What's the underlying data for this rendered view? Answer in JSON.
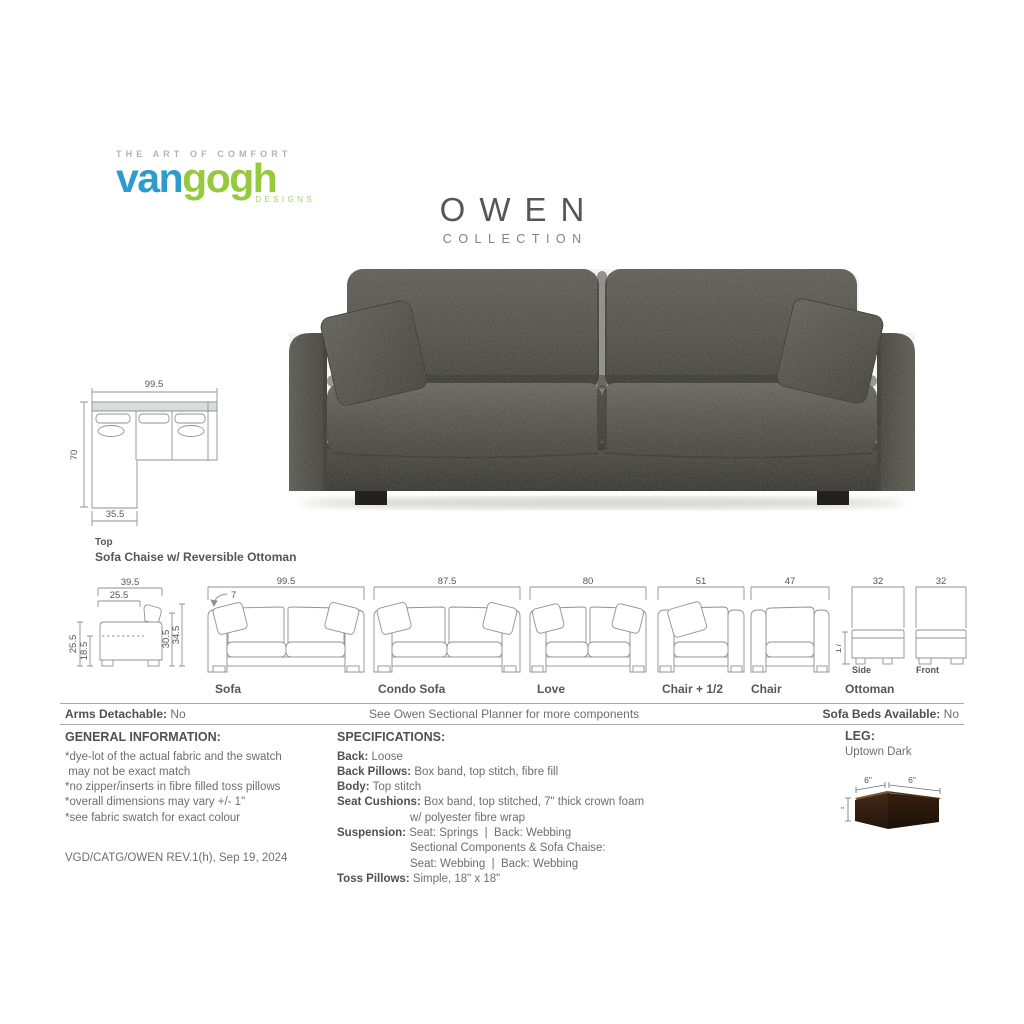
{
  "brand": {
    "tagline": "THE ART OF COMFORT",
    "name_blue": "van",
    "name_green": "gogh",
    "designs": "DESIGNS"
  },
  "collection": {
    "name": "OWEN",
    "subtitle": "COLLECTION"
  },
  "colors": {
    "logo_blue": "#2d9ccd",
    "logo_green": "#96c93d",
    "heading_gray": "#4f5054",
    "body_gray": "#6d6e71",
    "drawing_line": "#8f9194",
    "sofa_fabric": "#4c4c46",
    "leg_brown": "#3a2417"
  },
  "chaise_drawing": {
    "width": "99.5",
    "depth": "70",
    "chaise_width": "35.5",
    "view_label": "Top",
    "caption": "Sofa Chaise w/ Reversible Ottoman"
  },
  "side_view": {
    "top_width": "39.5",
    "seat_depth": "25.5",
    "arm_height": "25.5",
    "seat_height": "18.5",
    "back_height": "30.5",
    "total_height": "34.5"
  },
  "components": {
    "sofa": {
      "label": "Sofa",
      "width": "99.5",
      "arm_width": "7"
    },
    "condo_sofa": {
      "label": "Condo Sofa",
      "width": "87.5"
    },
    "love": {
      "label": "Love",
      "width": "80"
    },
    "chair_half": {
      "label": "Chair + 1/2",
      "width": "51"
    },
    "chair": {
      "label": "Chair",
      "width": "47"
    },
    "ottoman": {
      "label": "Ottoman",
      "side_width": "32",
      "front_width": "32",
      "height": "17",
      "side_label": "Side",
      "front_label": "Front"
    }
  },
  "info_bar": {
    "left_label": "Arms Detachable:",
    "left_value": " No",
    "center": "See Owen Sectional Planner for more components",
    "right_label": "Sofa Beds Available:",
    "right_value": " No"
  },
  "general_info": {
    "heading": "GENERAL INFORMATION:",
    "items": [
      "*dye-lot of the actual fabric and the swatch\n may not be exact match",
      "*no zipper/inserts in fibre filled toss pillows",
      "*overall dimensions may vary +/- 1\"",
      "*see fabric swatch for exact colour"
    ]
  },
  "specifications": {
    "heading": "SPECIFICATIONS:",
    "rows": [
      {
        "label": "Back:",
        "lines": [
          " Loose"
        ]
      },
      {
        "label": "Back Pillows:",
        "lines": [
          " Box band, top stitch, fibre fill"
        ]
      },
      {
        "label": "Body:",
        "lines": [
          " Top stitch"
        ]
      },
      {
        "label": "Seat Cushions:",
        "lines": [
          " Box band, top stitched, 7\" thick crown foam",
          "w/ polyester fibre wrap"
        ]
      },
      {
        "label": "Suspension:",
        "lines": [
          " Seat: Springs  |  Back: Webbing",
          "Sectional Components & Sofa Chaise:",
          "Seat: Webbing  |  Back: Webbing"
        ]
      },
      {
        "label": "Toss Pillows:",
        "lines": [
          " Simple, 18\" x 18\""
        ]
      }
    ]
  },
  "leg": {
    "heading": "LEG:",
    "name": "Uptown Dark",
    "top_left_dim": "6\"",
    "top_right_dim": "6\"",
    "height_dim": "3\""
  },
  "footer": {
    "revision": "VGD/CATG/OWEN REV.1(h), Sep 19, 2024"
  }
}
